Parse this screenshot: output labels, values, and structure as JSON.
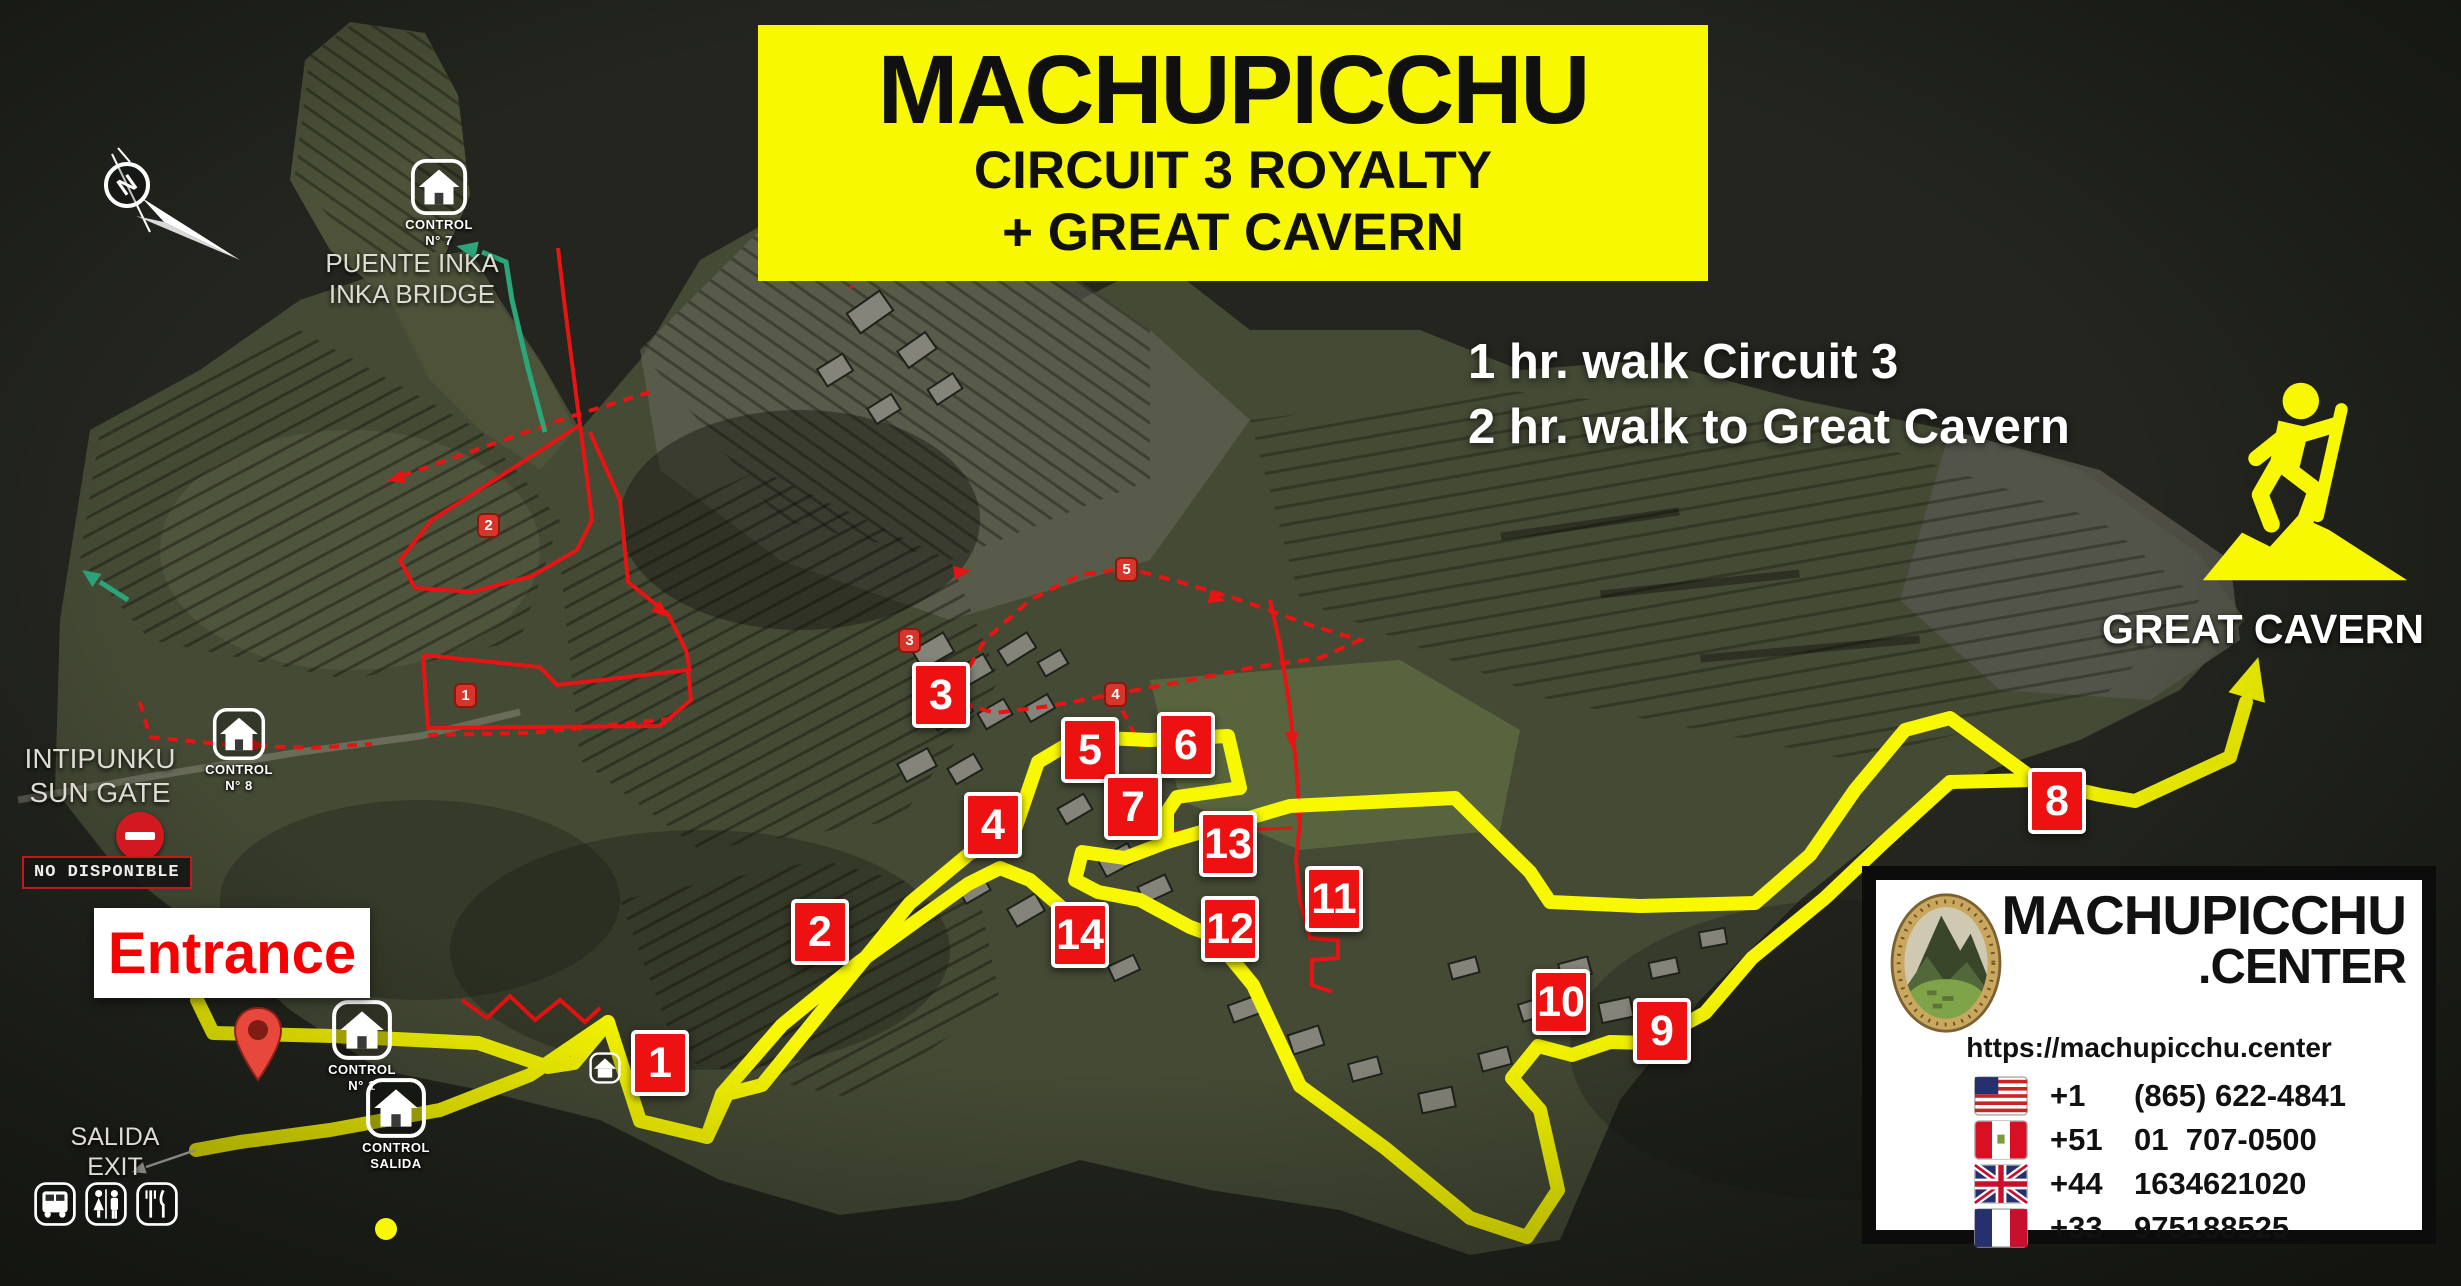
{
  "banner": {
    "title": "MACHUPICCHU",
    "subtitle1": "CIRCUIT 3 ROYALTY",
    "subtitle2": "+ GREAT CAVERN",
    "bg_color": "#f8f800"
  },
  "walk_info": {
    "line1": "1 hr. walk Circuit 3",
    "line2": "2 hr. walk to Great Cavern"
  },
  "great_cavern": {
    "label": "GREAT CAVERN",
    "icon": "hiker-mountain-icon"
  },
  "compass": {
    "north_letter": "N"
  },
  "entrance": {
    "label": "Entrance",
    "text_color": "#f80000"
  },
  "exit": {
    "line1": "SALIDA",
    "line2": "EXIT",
    "amenities": [
      "bus-icon",
      "restroom-icon",
      "restaurant-icon"
    ]
  },
  "sun_gate": {
    "line1": "INTIPUNKU",
    "line2": "SUN GATE",
    "status": "NO DISPONIBLE"
  },
  "inka_bridge": {
    "line1": "PUENTE INKA",
    "line2": "INKA BRIDGE"
  },
  "controls": {
    "n1": {
      "line1": "CONTROL",
      "line2": "N° 1"
    },
    "salida": {
      "line1": "CONTROL",
      "line2": "SALIDA"
    },
    "n7": {
      "line1": "CONTROL",
      "line2": "N° 7"
    },
    "n8": {
      "line1": "CONTROL",
      "line2": "N° 8"
    }
  },
  "waypoints": [
    "1",
    "2",
    "3",
    "4",
    "5",
    "6",
    "7",
    "8",
    "9",
    "10",
    "11",
    "12",
    "13",
    "14"
  ],
  "sub_markers": [
    "1",
    "2",
    "3",
    "4",
    "5"
  ],
  "info_card": {
    "brand_top": "MACHUPICCHU",
    "brand_bottom": ".CENTER",
    "url": "https://machupicchu.center",
    "phones": [
      {
        "country": "USA",
        "code": "+1",
        "number": "(865) 622-4841"
      },
      {
        "country": "Peru",
        "code": "+51",
        "number": "01  707-0500"
      },
      {
        "country": "UK",
        "code": "+44",
        "number": "1634621020"
      },
      {
        "country": "France",
        "code": "+33",
        "number": "975188525"
      }
    ]
  },
  "colors": {
    "route_yellow": "#f8f800",
    "circuit_red": "#e81313",
    "marker_red": "#ee1111",
    "terrain_green": "#454a35",
    "map_dark": "#23251e"
  }
}
